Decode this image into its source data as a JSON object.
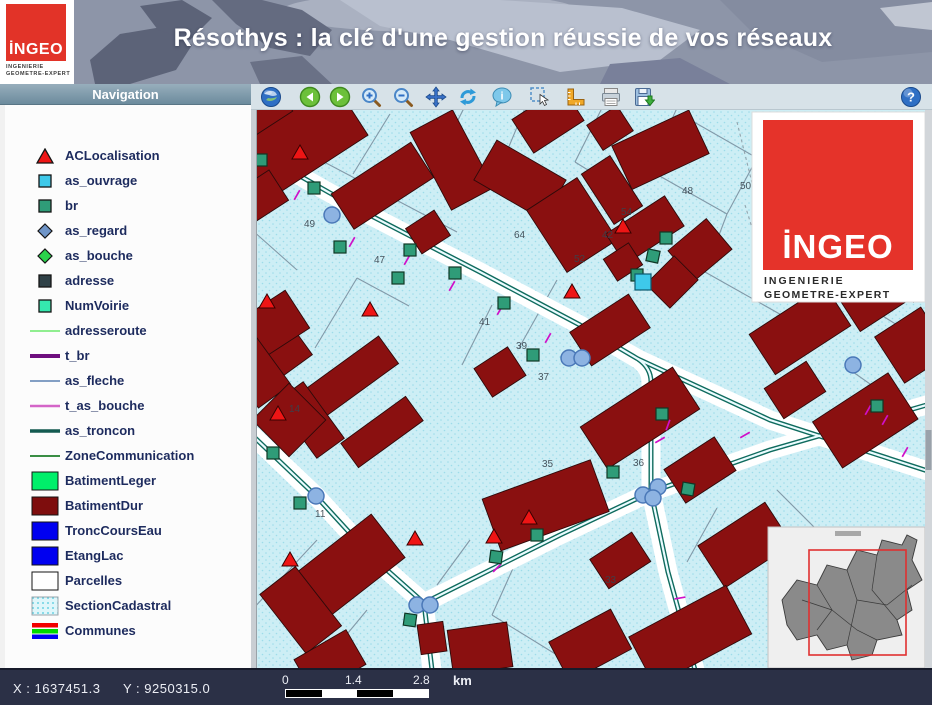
{
  "header": {
    "title": "Résothys : la clé d'une gestion réussie de vos réseaux",
    "logo": {
      "wordmark": "İNGEO",
      "line1": "INGENIERIE",
      "line2": "GEOMETRE-EXPERT"
    }
  },
  "navigation": {
    "title": "Navigation"
  },
  "toolbar": {
    "icons": [
      {
        "name": "globe-icon"
      },
      {
        "name": "back-icon"
      },
      {
        "name": "forward-icon"
      },
      {
        "name": "zoom-in-icon"
      },
      {
        "name": "zoom-out-icon"
      },
      {
        "name": "pan-icon"
      },
      {
        "name": "refresh-icon"
      },
      {
        "name": "info-icon"
      },
      {
        "name": "select-icon"
      },
      {
        "name": "measure-icon"
      },
      {
        "name": "print-icon"
      },
      {
        "name": "save-icon"
      }
    ],
    "help_icon": "help-icon"
  },
  "sidebar": {
    "layers": [
      {
        "label": "ACLocalisation",
        "symbol": "triangle",
        "color": "#ee1515"
      },
      {
        "label": "as_ouvrage",
        "symbol": "square",
        "color": "#3ec9ea"
      },
      {
        "label": "br",
        "symbol": "square",
        "color": "#2f9c78"
      },
      {
        "label": "as_regard",
        "symbol": "diamond",
        "color": "#6f95c8"
      },
      {
        "label": "as_bouche",
        "symbol": "diamond",
        "color": "#2bd24b"
      },
      {
        "label": "adresse",
        "symbol": "square",
        "color": "#2f4147"
      },
      {
        "label": "NumVoirie",
        "symbol": "square",
        "color": "#35e8ae"
      },
      {
        "label": "adresseroute",
        "symbol": "line",
        "color": "#90ee90",
        "weight": 2
      },
      {
        "label": "t_br",
        "symbol": "line",
        "color": "#6e0f7e",
        "weight": 4
      },
      {
        "label": "as_fleche",
        "symbol": "line",
        "color": "#5b80b2",
        "weight": 1.6
      },
      {
        "label": "t_as_bouche",
        "symbol": "line",
        "color": "#d465c8",
        "weight": 2.5
      },
      {
        "label": "as_troncon",
        "symbol": "line",
        "color": "#145a50",
        "weight": 3.5
      },
      {
        "label": "ZoneCommunication",
        "symbol": "line",
        "color": "#1e7e2a",
        "weight": 1.8
      },
      {
        "label": "BatimentLeger",
        "symbol": "rect",
        "color": "#00ef6a"
      },
      {
        "label": "BatimentDur",
        "symbol": "rect",
        "color": "#7e0d0d"
      },
      {
        "label": "TroncCoursEau",
        "symbol": "rect",
        "color": "#0000f0"
      },
      {
        "label": "EtangLac",
        "symbol": "rect",
        "color": "#0000f0"
      },
      {
        "label": "Parcelles",
        "symbol": "rect",
        "color": "#ffffff"
      },
      {
        "label": "SectionCadastral",
        "symbol": "rect-dots",
        "color": "#dff6fa"
      },
      {
        "label": "Communes",
        "symbol": "tricolor",
        "colors": [
          "#f20000",
          "#00d800",
          "#0000f2"
        ]
      }
    ]
  },
  "map": {
    "overlay_logo": {
      "wordmark": "İNGEO",
      "line1": "INGENIERIE",
      "line2": "GEOMETRE-EXPERT"
    },
    "parcel_numbers": [
      {
        "t": "49",
        "x": 304,
        "y": 227
      },
      {
        "t": "47",
        "x": 374,
        "y": 263
      },
      {
        "t": "41",
        "x": 479,
        "y": 325
      },
      {
        "t": "39",
        "x": 516,
        "y": 349
      },
      {
        "t": "37",
        "x": 538,
        "y": 380
      },
      {
        "t": "64",
        "x": 514,
        "y": 238
      },
      {
        "t": "52",
        "x": 574,
        "y": 262
      },
      {
        "t": "54",
        "x": 621,
        "y": 215
      },
      {
        "t": "42",
        "x": 602,
        "y": 238
      },
      {
        "t": "48",
        "x": 682,
        "y": 194
      },
      {
        "t": "50",
        "x": 740,
        "y": 189
      },
      {
        "t": "62",
        "x": 905,
        "y": 262
      },
      {
        "t": "14",
        "x": 289,
        "y": 412
      },
      {
        "t": "11",
        "x": 315,
        "y": 517
      },
      {
        "t": "35",
        "x": 542,
        "y": 467
      },
      {
        "t": "36",
        "x": 633,
        "y": 466
      },
      {
        "t": "33",
        "x": 605,
        "y": 583
      }
    ],
    "colors": {
      "background": "#c9edf5",
      "building": "#8a1010",
      "network": "#0f6b5e",
      "regard": "#8db3e2",
      "tick": "#cf10c8"
    }
  },
  "statusbar": {
    "x_label": "X : 1637451.3",
    "y_label": "Y : 9250315.0",
    "scale": {
      "start": "0",
      "mid": "1.4",
      "end": "2.8",
      "unit": "km"
    }
  }
}
